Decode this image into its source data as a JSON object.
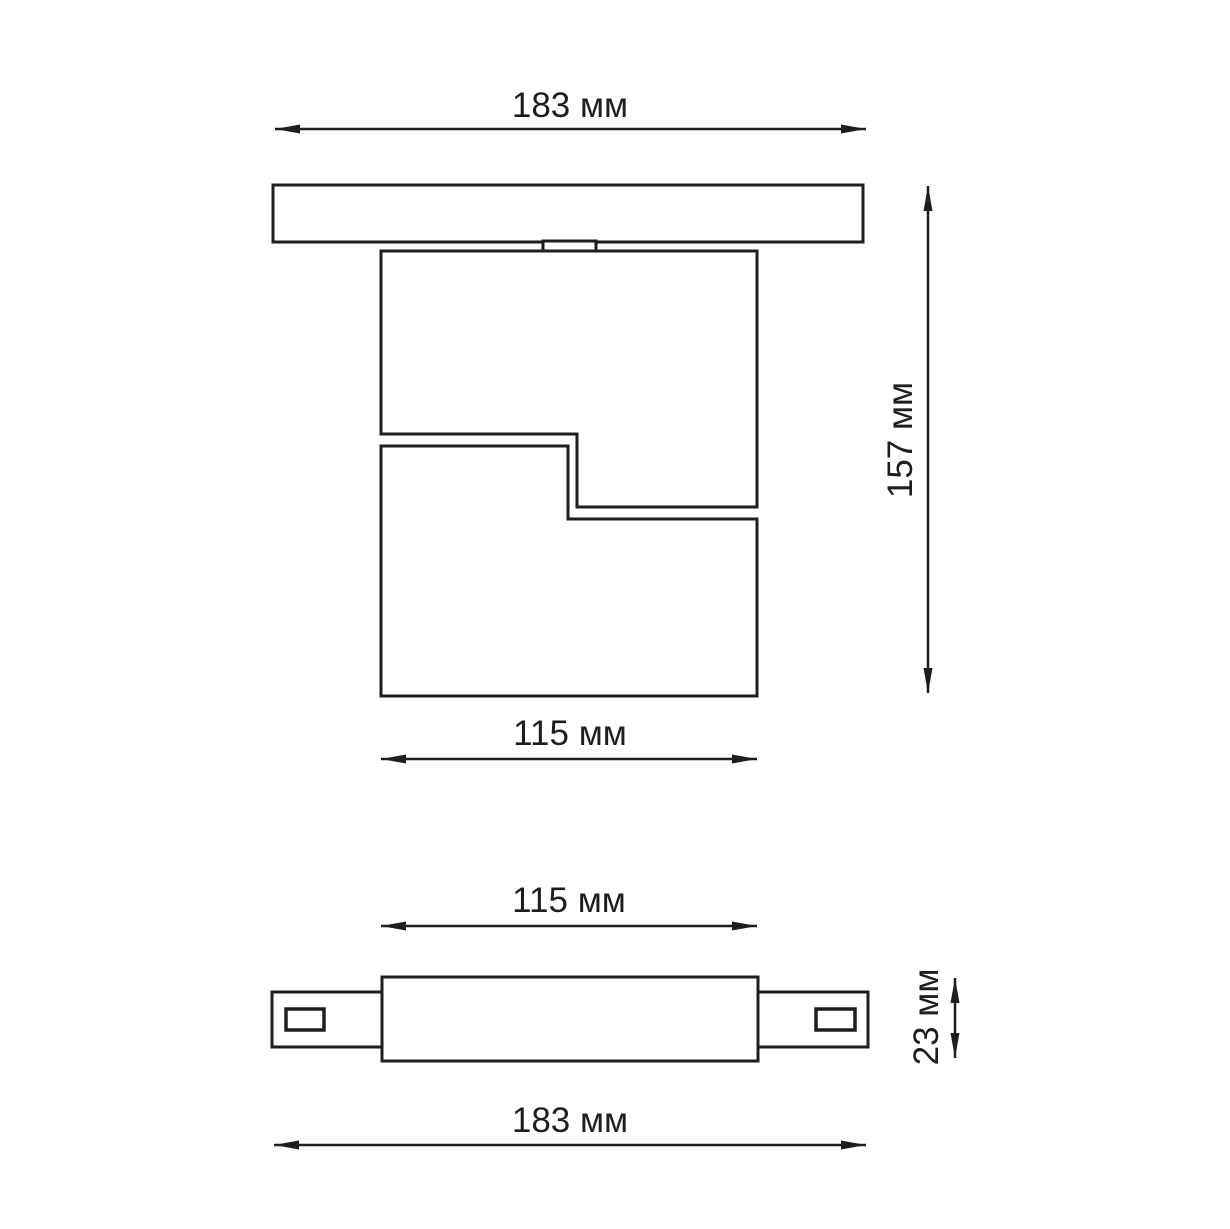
{
  "colors": {
    "line": "#1e1e1e",
    "background": "#ffffff"
  },
  "top_view": {
    "dim_track_width": "183 мм",
    "dim_overall_height": "157 мм",
    "dim_body_width": "115 мм"
  },
  "side_view": {
    "dim_body_width": "115 мм",
    "dim_track_height": "23 мм",
    "dim_track_length": "183 мм"
  }
}
